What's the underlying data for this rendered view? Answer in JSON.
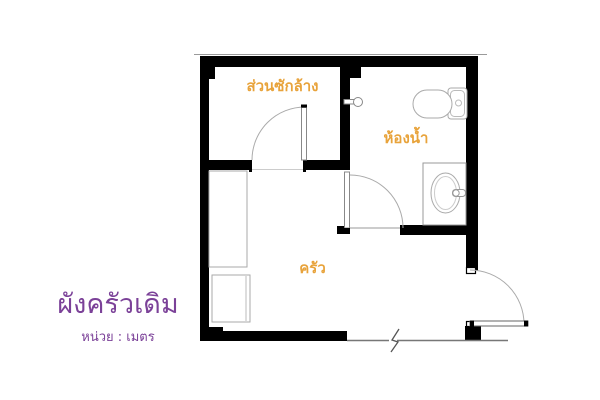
{
  "plan": {
    "title": "ผังครัวเดิม",
    "unit": "หน่วย : เมตร",
    "rooms": [
      {
        "id": "laundry",
        "label": "ส่วนซักล้าง"
      },
      {
        "id": "bathroom",
        "label": "ห้องน้ำ"
      },
      {
        "id": "kitchen",
        "label": "ครัว"
      }
    ],
    "colors": {
      "room_label": "#e8a33b",
      "title_text": "#7b4198",
      "wall": "#000000",
      "fixture_line": "#9a9a9a"
    },
    "fixtures": [
      "toilet",
      "sink-counter",
      "shower-valve",
      "kitchen-counter",
      "appliance"
    ],
    "door_count": 3
  }
}
